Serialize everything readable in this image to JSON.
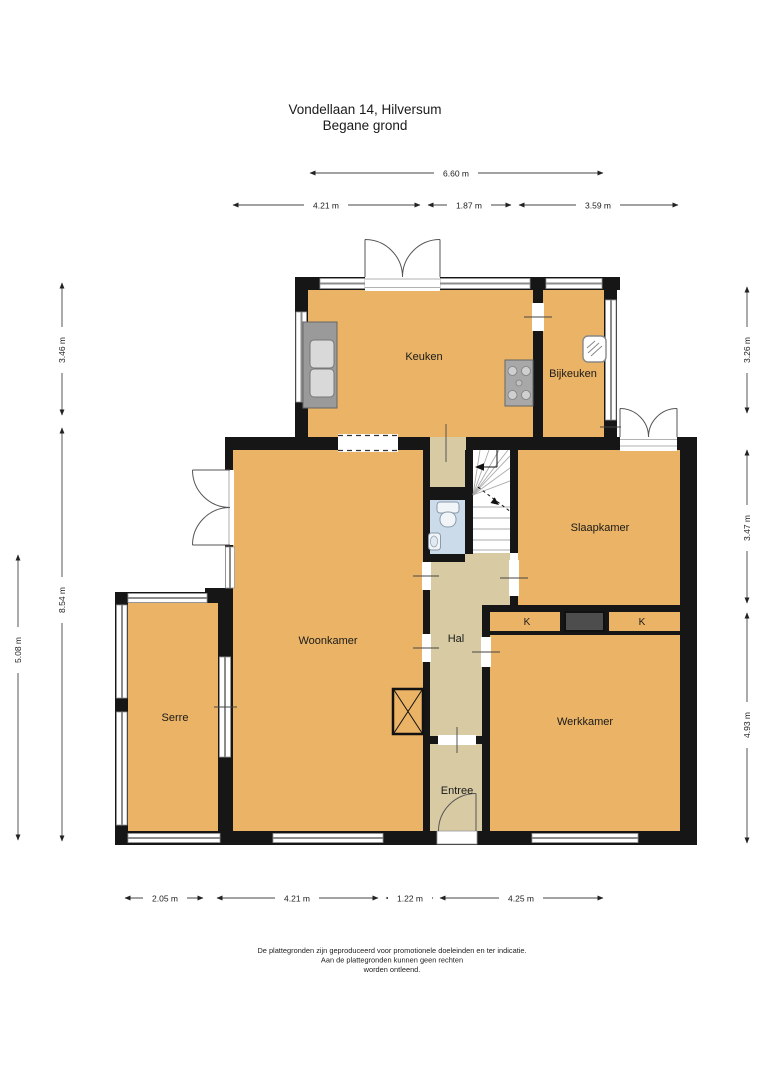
{
  "title": {
    "line1": "Vondellaan 14, Hilversum",
    "line2": "Begane grond"
  },
  "rooms": {
    "keuken": "Keuken",
    "bijkeuken": "Bijkeuken",
    "slaapkamer": "Slaapkamer",
    "woonkamer": "Woonkamer",
    "hal": "Hal",
    "serre": "Serre",
    "werkkamer": "Werkkamer",
    "entree": "Entree",
    "closet_left": "K",
    "closet_right": "K"
  },
  "dimensions": {
    "top_total": "6.60 m",
    "top": [
      "4.21 m",
      "1.87 m",
      "3.59 m"
    ],
    "left": [
      "3.46 m",
      "8.54 m",
      "5.08 m"
    ],
    "right": [
      "3.26 m",
      "3.47 m",
      "4.93 m"
    ],
    "bottom": [
      "2.05 m",
      "4.21 m",
      "1.22 m",
      "4.25 m"
    ]
  },
  "footer": [
    "De plattegronden zijn geproduceerd voor promotionele doeleinden en ter indicatie.",
    "Aan de plattegronden kunnen geen rechten",
    "worden ontleend."
  ],
  "colors": {
    "room": "#EAB365",
    "hall": "#D8CBA4",
    "wet": "#CBDBE9",
    "wall": "#161616",
    "window": "#8C8C8C",
    "fixture": "#9A9A9A",
    "fixture_light": "#D9D9D9",
    "chimney": "#4D4D4D",
    "dim": "#444444",
    "text": "#1A1A1A"
  }
}
